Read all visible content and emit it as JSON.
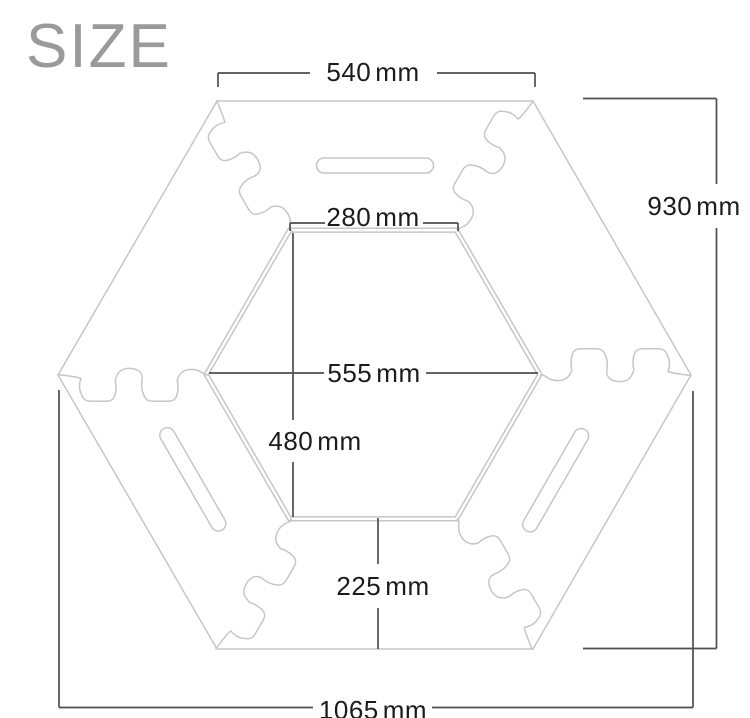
{
  "title": "SIZE",
  "colors": {
    "background": "#ffffff",
    "outline": "#c6c6c6",
    "dimension_line": "#4f4f4f",
    "label_text": "#1b1b1b",
    "title_text": "#9a9a9a"
  },
  "dimensions": {
    "outer_top_edge": {
      "value": "540",
      "unit": "mm"
    },
    "overall_height": {
      "value": "930",
      "unit": "mm"
    },
    "inner_top_edge": {
      "value": "280",
      "unit": "mm"
    },
    "inner_width": {
      "value": "555",
      "unit": "mm"
    },
    "inner_height": {
      "value": "480",
      "unit": "mm"
    },
    "bottom_ring_depth": {
      "value": "225",
      "unit": "mm"
    },
    "overall_width": {
      "value": "1065",
      "unit": "mm"
    }
  }
}
